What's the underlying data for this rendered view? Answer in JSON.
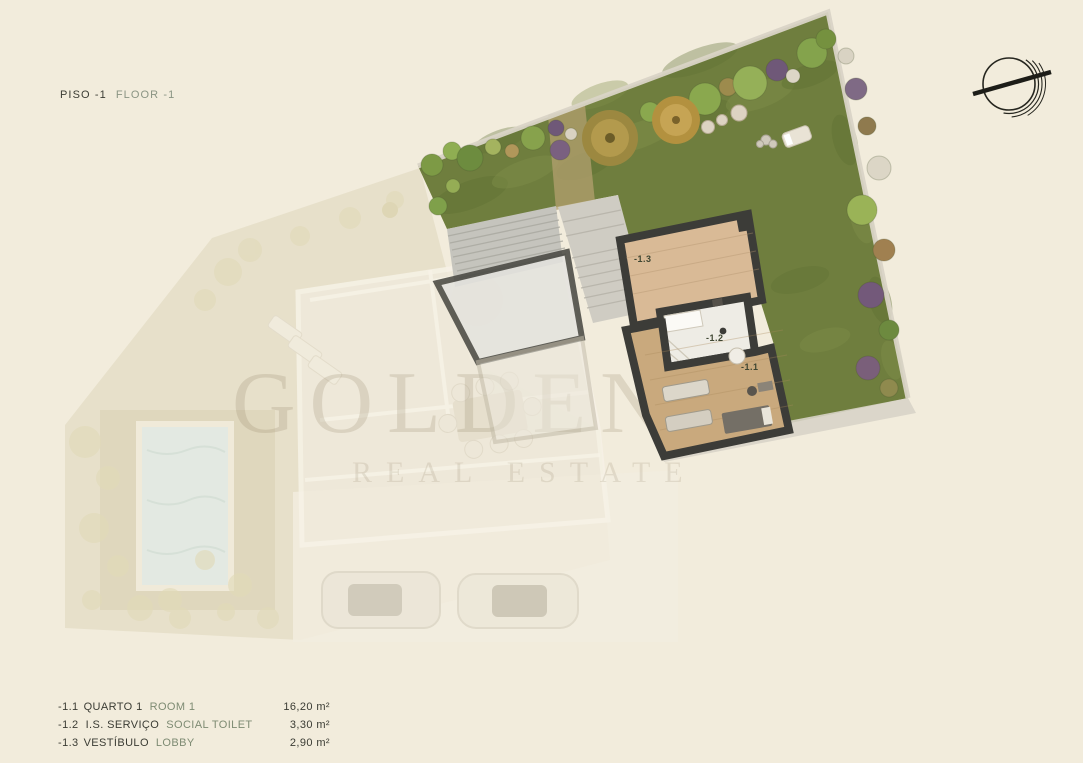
{
  "header": {
    "title_pt": "PISO -1",
    "title_en": "FLOOR -1"
  },
  "watermark": {
    "line1": "GOLDEN H",
    "line2": "REAL ESTATE"
  },
  "plan": {
    "labels": [
      {
        "text": "-1.3"
      },
      {
        "text": "-1.2"
      },
      {
        "text": "-1.1"
      }
    ]
  },
  "legend": {
    "rows": [
      {
        "code": "-1.1",
        "name_pt": "QUARTO 1",
        "name_en": "ROOM 1",
        "area": "16,20 m²"
      },
      {
        "code": "-1.2",
        "name_pt": "I.S. SERVIÇO",
        "name_en": "SOCIAL TOILET",
        "area": "3,30 m²"
      },
      {
        "code": "-1.3",
        "name_pt": "VESTÍBULO",
        "name_en": "LOBBY",
        "area": "2,90 m²"
      }
    ]
  },
  "icons": {
    "logo": "circle-slash-monogram-icon"
  },
  "colors": {
    "background": "#F2ECDC",
    "ink": "#3B3C34",
    "muted_green": "#7E8B73",
    "plan_label": "#3F4632",
    "lawn": "#6F7E3E",
    "wall": "#3C3C38",
    "floor_tan": "#D9BA96",
    "floor_wood": "#C9A97D",
    "floor_wc": "#EEECE5",
    "pool": "#DFE9E4",
    "logo_ink": "#26261F"
  }
}
